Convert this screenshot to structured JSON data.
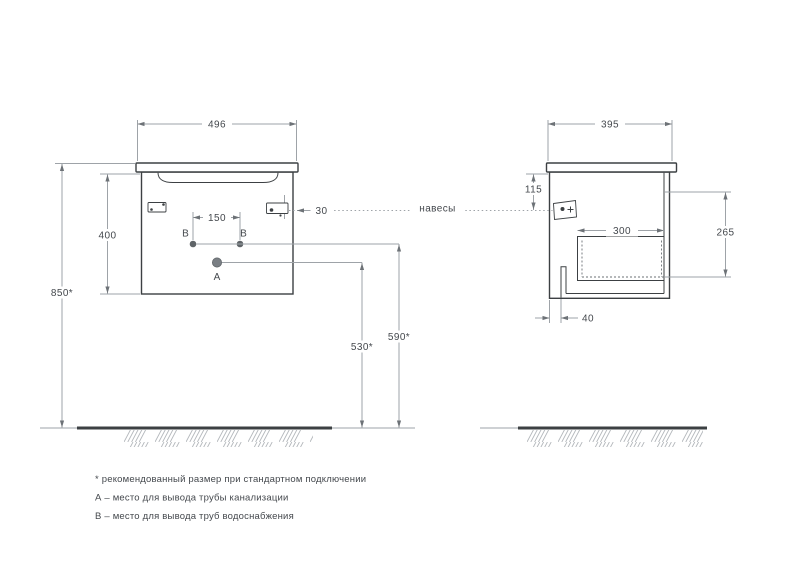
{
  "dims": {
    "front_width": "496",
    "front_height": "400",
    "mount_height": "850*",
    "b_spacing": "150",
    "hanger_offset": "30",
    "drain_height": "530*",
    "water_height": "590*",
    "side_depth": "395",
    "hanger_drop": "115",
    "drawer_depth": "300",
    "side_inner_height": "265",
    "slot_offset": "40"
  },
  "labels": {
    "hangers": "навесы",
    "point_a": "А",
    "point_b": "В"
  },
  "notes": [
    "* рекомендованный размер при стандартном подключении",
    "А – место для вывода трубы канализации",
    "В – место для вывода труб водоснабжения"
  ],
  "colors": {
    "outline": "#3c4043",
    "dimension": "#9ea3a8",
    "text": "#44484d"
  }
}
